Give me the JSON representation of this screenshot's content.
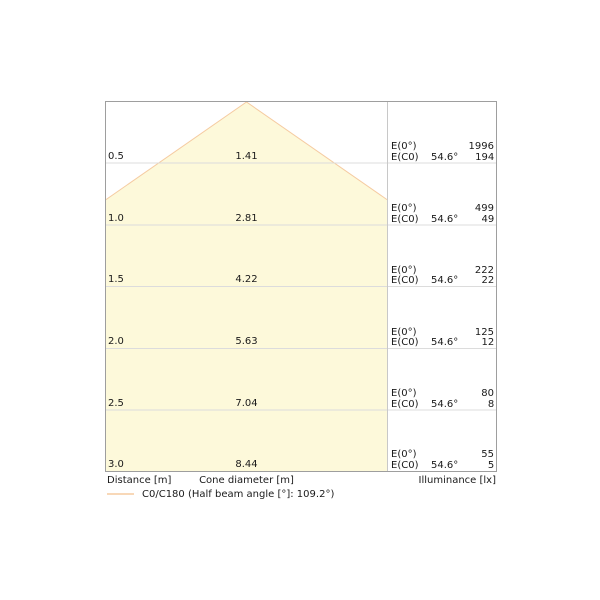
{
  "chart_data": {
    "type": "cone-diagram",
    "title": "",
    "description": "Luminaire light cone diagram: cone diameter and illuminance versus distance",
    "legend": "C0/C180 (Half beam angle [°]: 109.2°)",
    "half_beam_angle_full_deg": 109.2,
    "half_beam_angle_deg": 54.6,
    "axis_labels": {
      "distance": "Distance [m]",
      "cone_diameter": "Cone diameter [m]",
      "illuminance": "Illuminance [lx]"
    },
    "rows": [
      {
        "distance": "0.5",
        "cone_diameter": "1.41",
        "e0_label": "E(0°)",
        "ec0_label": "E(C0)",
        "angle": "54.6°",
        "e0_lx": "1996",
        "ec0_lx": "194"
      },
      {
        "distance": "1.0",
        "cone_diameter": "2.81",
        "e0_label": "E(0°)",
        "ec0_label": "E(C0)",
        "angle": "54.6°",
        "e0_lx": "499",
        "ec0_lx": "49"
      },
      {
        "distance": "1.5",
        "cone_diameter": "4.22",
        "e0_label": "E(0°)",
        "ec0_label": "E(C0)",
        "angle": "54.6°",
        "e0_lx": "222",
        "ec0_lx": "22"
      },
      {
        "distance": "2.0",
        "cone_diameter": "5.63",
        "e0_label": "E(0°)",
        "ec0_label": "E(C0)",
        "angle": "54.6°",
        "e0_lx": "125",
        "ec0_lx": "12"
      },
      {
        "distance": "2.5",
        "cone_diameter": "7.04",
        "e0_label": "E(0°)",
        "ec0_label": "E(C0)",
        "angle": "54.6°",
        "e0_lx": "80",
        "ec0_lx": "8"
      },
      {
        "distance": "3.0",
        "cone_diameter": "8.44",
        "e0_label": "E(0°)",
        "ec0_label": "E(C0)",
        "angle": "54.6°",
        "e0_lx": "55",
        "ec0_lx": "5"
      }
    ],
    "distances_m": [
      0.5,
      1.0,
      1.5,
      2.0,
      2.5,
      3.0
    ],
    "cone_diameters_m": [
      1.41,
      2.81,
      4.22,
      5.63,
      7.04,
      8.44
    ],
    "illuminance_e0_lx": [
      1996,
      499,
      222,
      125,
      80,
      55
    ],
    "illuminance_ec0_lx": [
      194,
      49,
      22,
      12,
      8,
      5
    ],
    "layout": {
      "grid": "on",
      "legend_position": "bottom-left"
    },
    "colors": {
      "cone_fill": "#fdf9da",
      "cone_stroke": "#f5cba1",
      "grid_line": "#dcdcdc",
      "column_divider": "#c8c8c8",
      "chart_border": "#9e9e9e",
      "text": "#1a1a1a"
    }
  }
}
